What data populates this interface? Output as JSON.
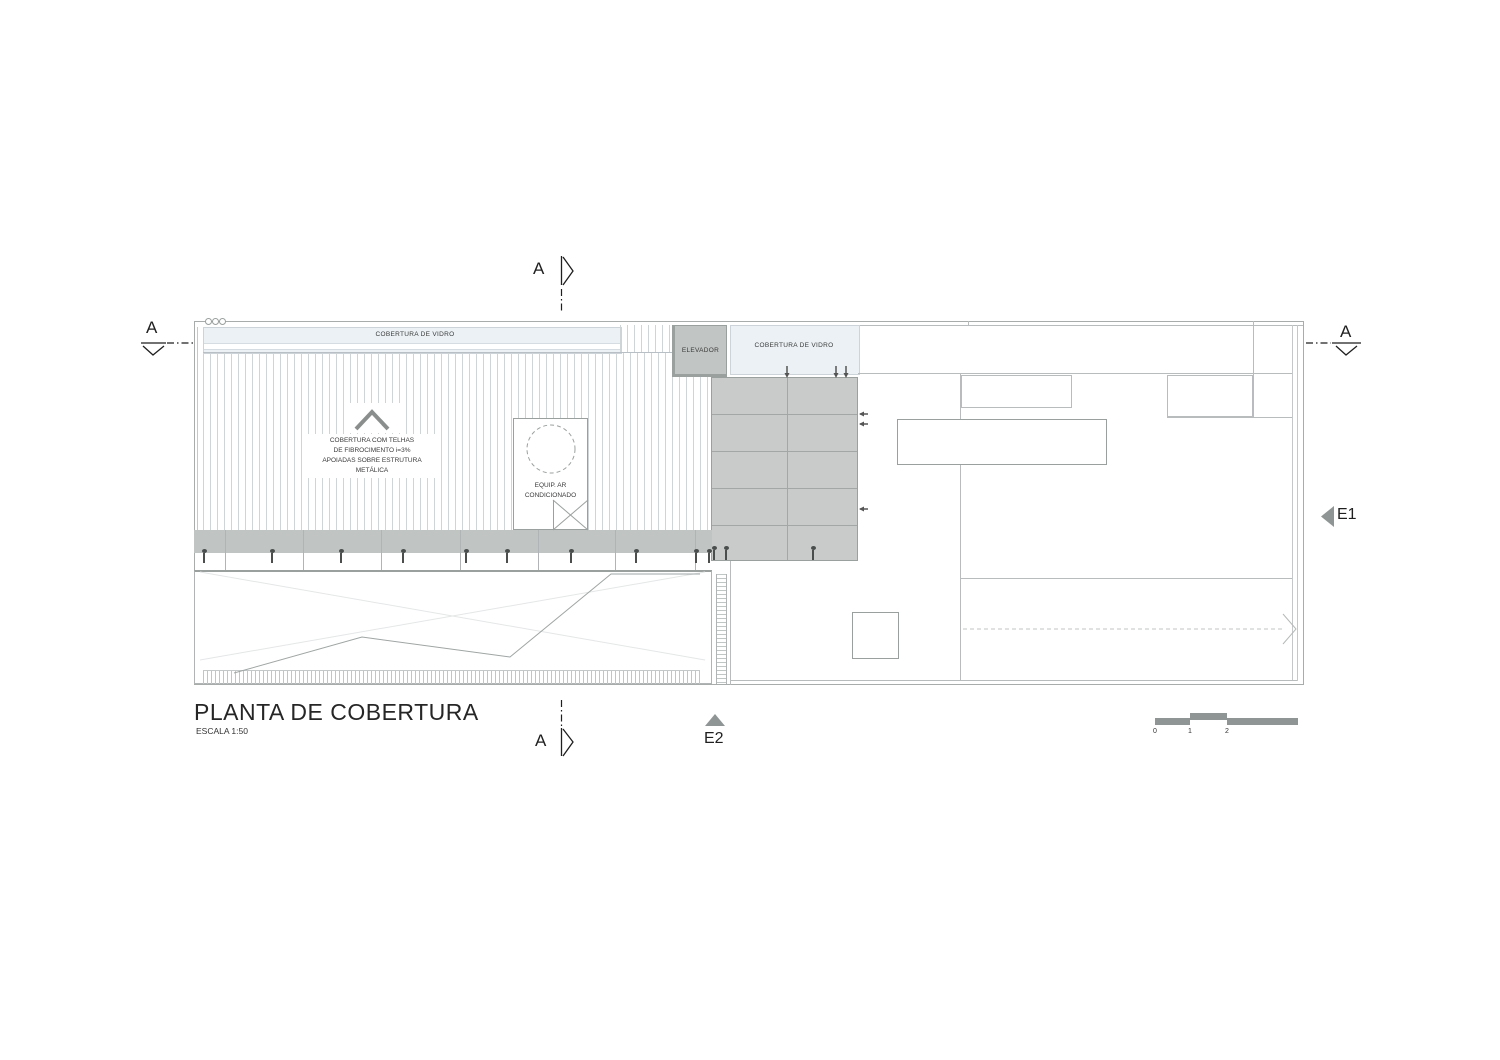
{
  "title": {
    "name": "PLANTA DE COBERTURA",
    "scale": "ESCALA 1:50"
  },
  "labels": {
    "glass_roof_1": "COBERTURA DE VIDRO",
    "glass_roof_2": "COBERTURA DE VIDRO",
    "elevator": "ELEVADOR",
    "roof_note": "COBERTURA COM TELHAS\nDE FIBROCIMENTO i=3%\nAPOIADAS SOBRE ESTRUTURA\nMETÁLICA",
    "ac_note": "EQUIP. AR\nCONDICIONADO"
  },
  "markers": {
    "section": "A",
    "elevation_1": "E1",
    "elevation_2": "E2"
  },
  "scale_bar": {
    "ticks": [
      "0",
      "1",
      "2"
    ]
  },
  "colors": {
    "glass": "#ebf1f4",
    "deck_gray": "#c8cbca",
    "edge_band_gray": "#c0c4c3",
    "marker_gray": "#8f9595",
    "outline": "#a8acab"
  }
}
